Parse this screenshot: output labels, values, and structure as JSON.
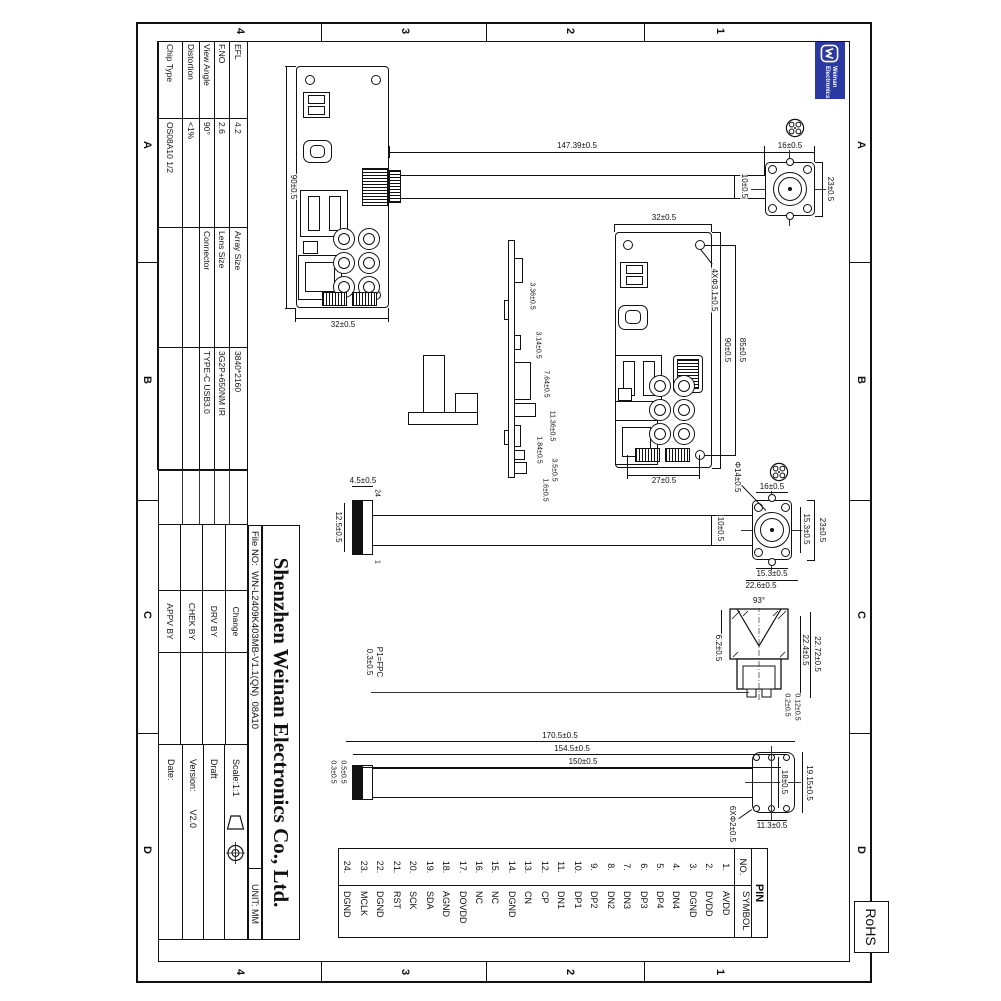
{
  "sheet": {
    "grid_letters": [
      "A",
      "B",
      "C",
      "D"
    ],
    "grid_numbers": [
      "1",
      "2",
      "3",
      "4"
    ],
    "rohs": "RoHS",
    "logo_line1": "Weinan",
    "logo_line2": "Electronics"
  },
  "title_block": {
    "company": "Shenzhen Weinan Electronics Co., Ltd.",
    "file_no": "File NO:  WN-L2409K403MB-V1.1(QN)  08A10",
    "unit": "UNIT: MM",
    "params1": [
      {
        "label": "EFL",
        "value": "4.2"
      },
      {
        "label": "F.NO",
        "value": "2.6"
      },
      {
        "label": "View Angle",
        "value": "90°"
      },
      {
        "label": "Distortion",
        "value": "<1%"
      },
      {
        "label": "Chip Type",
        "value": "OS08A10  1/2"
      }
    ],
    "params2": [
      {
        "label": "Array Size",
        "value": "3840*2160"
      },
      {
        "label": "Lens Size",
        "value": "3G2P+650NM IR"
      },
      {
        "label": "Connector",
        "value": "TYPE-C USB3.0"
      },
      {
        "label": "",
        "value": ""
      },
      {
        "label": "",
        "value": ""
      }
    ],
    "approval_rows": [
      "Change",
      "DRV BY",
      "CHEK BY",
      "APPV BY"
    ],
    "scale": "Scale:1:1",
    "draft": "Draft",
    "version_label": "Version:",
    "version_value": "V2.0",
    "date": "Date:"
  },
  "pin_table": {
    "title": "PIN",
    "col_no": "NO.",
    "col_symbol": "SYMBOL",
    "pins": [
      {
        "no": "1.",
        "symbol": "AVDD"
      },
      {
        "no": "2.",
        "symbol": "DVDD"
      },
      {
        "no": "3.",
        "symbol": "DGND"
      },
      {
        "no": "4.",
        "symbol": "DN4"
      },
      {
        "no": "5.",
        "symbol": "DP4"
      },
      {
        "no": "6.",
        "symbol": "DP3"
      },
      {
        "no": "7.",
        "symbol": "DN3"
      },
      {
        "no": "8.",
        "symbol": "DN2"
      },
      {
        "no": "9.",
        "symbol": "DP2"
      },
      {
        "no": "10.",
        "symbol": "DP1"
      },
      {
        "no": "11.",
        "symbol": "DN1"
      },
      {
        "no": "12.",
        "symbol": "CP"
      },
      {
        "no": "13.",
        "symbol": "CN"
      },
      {
        "no": "14.",
        "symbol": "DGND"
      },
      {
        "no": "15.",
        "symbol": "NC"
      },
      {
        "no": "16.",
        "symbol": "NC"
      },
      {
        "no": "17.",
        "symbol": "DOVDD"
      },
      {
        "no": "18.",
        "symbol": "AGND"
      },
      {
        "no": "19.",
        "symbol": "SDA"
      },
      {
        "no": "20.",
        "symbol": "SCK"
      },
      {
        "no": "21.",
        "symbol": "RST"
      },
      {
        "no": "22.",
        "symbol": "DGND"
      },
      {
        "no": "23.",
        "symbol": "MCLK"
      },
      {
        "no": "24.",
        "symbol": "DGND"
      }
    ]
  },
  "dims": {
    "pcb1_len": "90±0.5",
    "pcb1_wid": "32±0.5",
    "cable1_len": "147.39±0.5",
    "cable1_wid": "10±0.5",
    "lens1_wid": "23±0.5",
    "lens1_hgt": "16±0.5",
    "pcb2_wid": "32±0.5",
    "pcb2_len": "90±0.5",
    "pcb2_hole_len": "85±0.5",
    "pcb2_hole_wid": "27±0.5",
    "pcb2_holes": "4XΦ3.1±0.5",
    "side_a": "3.36±0.5",
    "side_b": "3.14±0.5",
    "side_c": "7.64±0.5",
    "side_d": "11.36±0.5",
    "side_e": "1.84±0.5",
    "side_f": "3.5±0.5",
    "side_g": "1.6±0.5",
    "lens2_wid": "23±0.5",
    "lens2_inner_wid": "15.3±0.5",
    "lens2_hgt": "16±0.5",
    "lens2_inner_hgt": "15.3±0.5",
    "lens2_outer": "22.6±0.5",
    "lens_barrel": "Φ14±0.5",
    "cable2_wid": "10±0.5",
    "ffc_hgt": "4.5±0.5",
    "ffc_wid": "12.5±0.5",
    "ffc_pin24": "24",
    "ffc_pin1": "1",
    "fpc_line1": "P1=FPC",
    "fpc_line2": "0.3±0.5",
    "fov": "93°",
    "sec_len_outer": "22.72±0.5",
    "sec_len_inner": "22.4±0.5",
    "sec_dia": "6.2±0.5",
    "sec_t1": "0.12±0.5",
    "sec_t2": "0.2±0.5",
    "c3_len1": "170.5±0.5",
    "c3_len2": "154.5±0.5",
    "c3_len3": "150±0.5",
    "c3_pitch": "18±0.5",
    "c3_wid": "19.15±0.5",
    "c3_hgt": "11.3±0.5",
    "c3_holes": "6XΦ2±0.5",
    "c3_t1": "0.5±0.5",
    "c3_t2": "0.3±0.5"
  }
}
